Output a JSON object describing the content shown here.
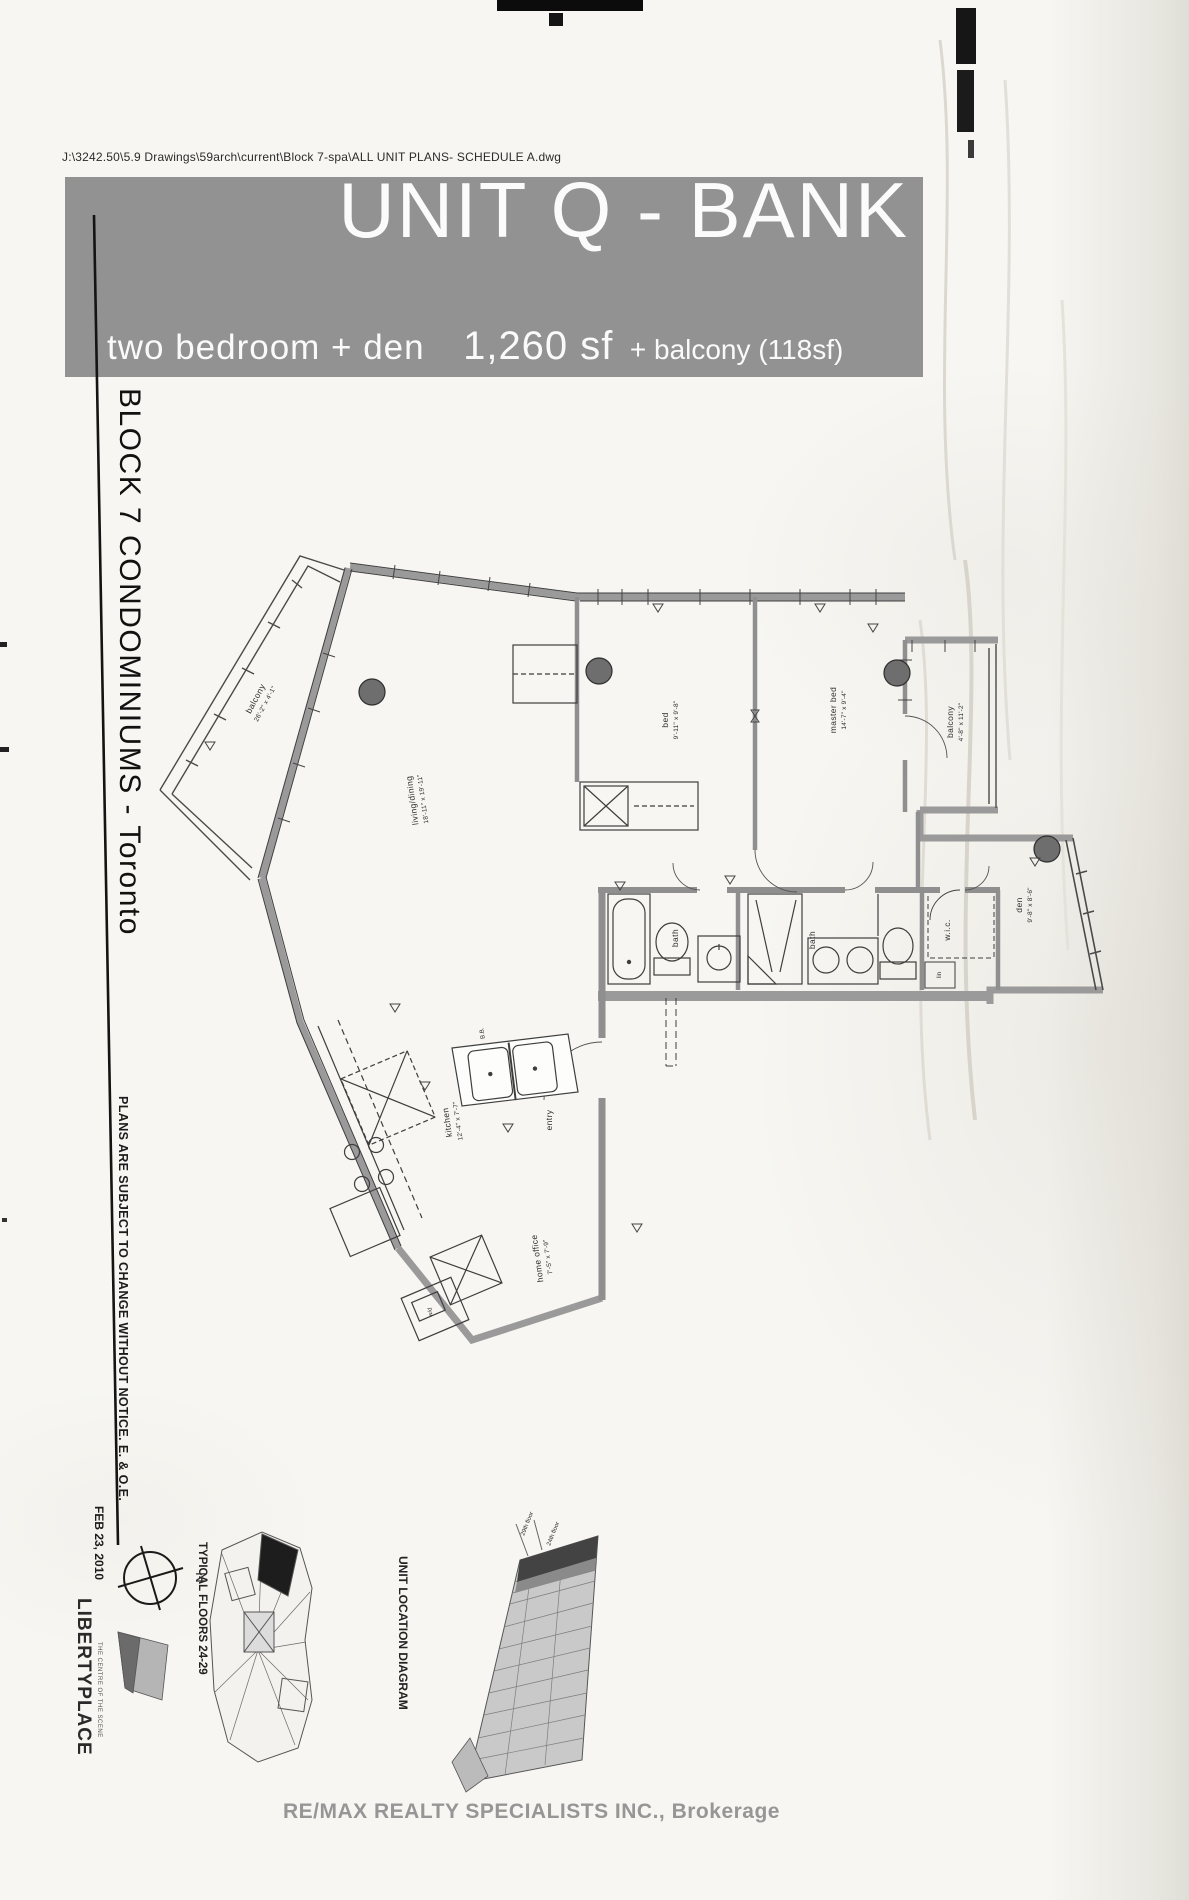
{
  "page": {
    "file_path": "J:\\3242.50\\5.9 Drawings\\59arch\\current\\Block 7-spa\\ALL UNIT PLANS-  SCHEDULE A.dwg"
  },
  "header": {
    "title": "UNIT Q - BANK",
    "subtitle_left": "two bedroom + den",
    "subtitle_size": "1,260 sf",
    "subtitle_balcony": "+ balcony (118sf)",
    "banner_color": "#929292"
  },
  "sidebar": {
    "project": "BLOCK 7 CONDOMINIUMS  - Toronto",
    "disclaimer": "PLANS ARE SUBJECT TO CHANGE WITHOUT NOTICE. E. & O.E.",
    "date": "FEB 23, 2010",
    "north_label": "N",
    "logo_title": "LIBERTYPLACE",
    "logo_tagline": "THE CENTRE OF THE SCENE"
  },
  "floor_plan": {
    "labels": {
      "balcony_left": {
        "name": "balcony",
        "dim": "26'-2\" x 4'-1\""
      },
      "living": {
        "name": "living/dining",
        "dim": "18'-11\" x 19'-11\""
      },
      "bed": {
        "name": "bed",
        "dim": "9'-11\" x 9'-8\""
      },
      "master": {
        "name": "master bed",
        "dim": "14'-7\" x 9'-4\""
      },
      "balcony_right": {
        "name": "balcony",
        "dim": "4'-8\" x 11'-2\""
      },
      "den": {
        "name": "den",
        "dim": "9'-8\" x 8'-6\""
      },
      "bath1": {
        "name": "bath"
      },
      "bath2": {
        "name": "bath"
      },
      "wic": {
        "name": "w.i.c."
      },
      "lin": {
        "name": "lin"
      },
      "kitchen": {
        "name": "kitchen",
        "dim": "12'-4\" x 7'-7\""
      },
      "entry": {
        "name": "entry"
      },
      "home_office": {
        "name": "home office",
        "dim": "7'-5\" x 7'-9\""
      },
      "wd": {
        "name": "w/d"
      },
      "bb": {
        "name": "B.B."
      }
    }
  },
  "footer": {
    "key_plan_label": "TYPICAL FLOORS 24-29",
    "unit_location_label": "UNIT LOCATION DIAGRAM",
    "floor_top_label": "29th floor",
    "floor_bottom_label": "24th floor",
    "brokerage": "RE/MAX REALTY SPECIALISTS INC., Brokerage"
  }
}
